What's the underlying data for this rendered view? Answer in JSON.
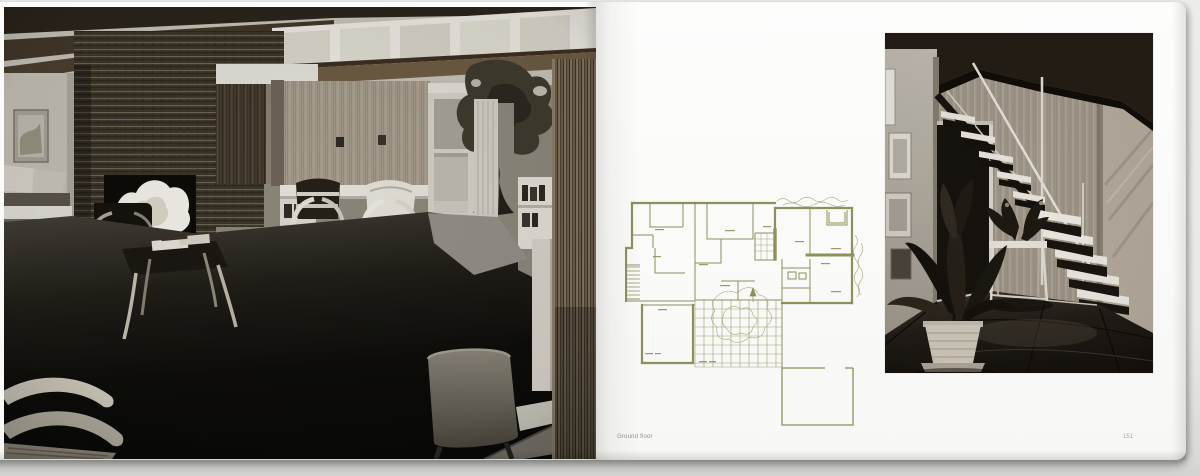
{
  "colors": {
    "backdrop": "#e8e8e6",
    "paper": "#fbfbf9",
    "plan_ink": "#8f8f5c",
    "caption_ink": "#90908c",
    "photo_shadow_dark": "#14110d"
  },
  "left_page": {
    "photo": {
      "alt": "Black-and-white photograph of a mid-century living room with brick fireplace, wood panelling, clerestory windows and bentwood armchairs on dark carpet"
    }
  },
  "right_page": {
    "plan": {
      "alt": "Ground-floor plan of the house drawn in olive-green ink with gridded terrace and detached patio square",
      "caption": "Ground floor"
    },
    "photo": {
      "alt": "Black-and-white photograph of a hallway with open-tread staircase, side table and potted plants"
    },
    "page_number": "151"
  }
}
